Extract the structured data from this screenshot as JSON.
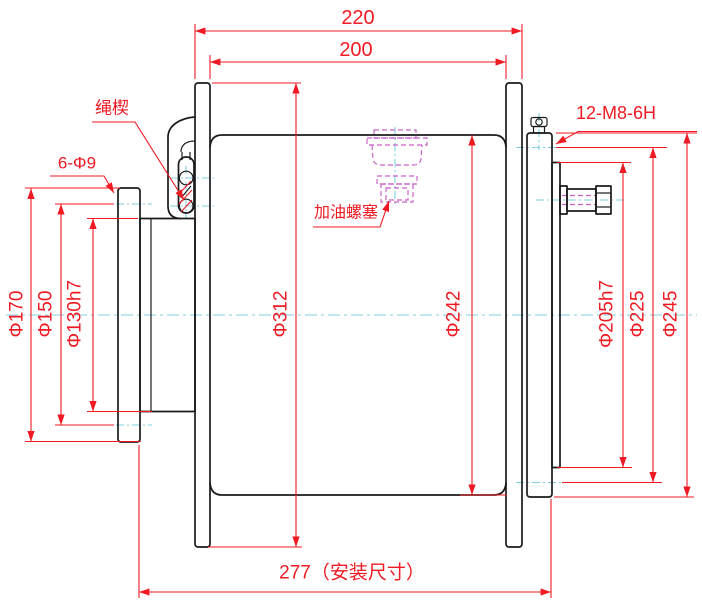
{
  "drawing": {
    "title": "winch-drum-section-drawing",
    "colors": {
      "background": "#ffffff",
      "outline": "#1b1b1b",
      "dimension": "#ef1a23",
      "centerline": "#7fd2e2",
      "hidden": "#c65fc6"
    },
    "dimensions": {
      "overall_width": "220",
      "inner_width": "200",
      "install_width": "277（安装尺寸）",
      "flange_od": "Φ312",
      "barrel_od": "Φ242",
      "left_flange_od": "Φ170",
      "left_bolt_circle": "Φ150",
      "left_spigot": "Φ130h7",
      "right_spigot": "Φ205h7",
      "right_bolt_circle": "Φ225",
      "right_flange_od": "Φ245"
    },
    "labels": {
      "rope_wedge": "绳楔",
      "bolt_holes": "6-Φ9",
      "oil_plug": "加油螺塞",
      "thread_spec": "12-M8-6H"
    }
  }
}
